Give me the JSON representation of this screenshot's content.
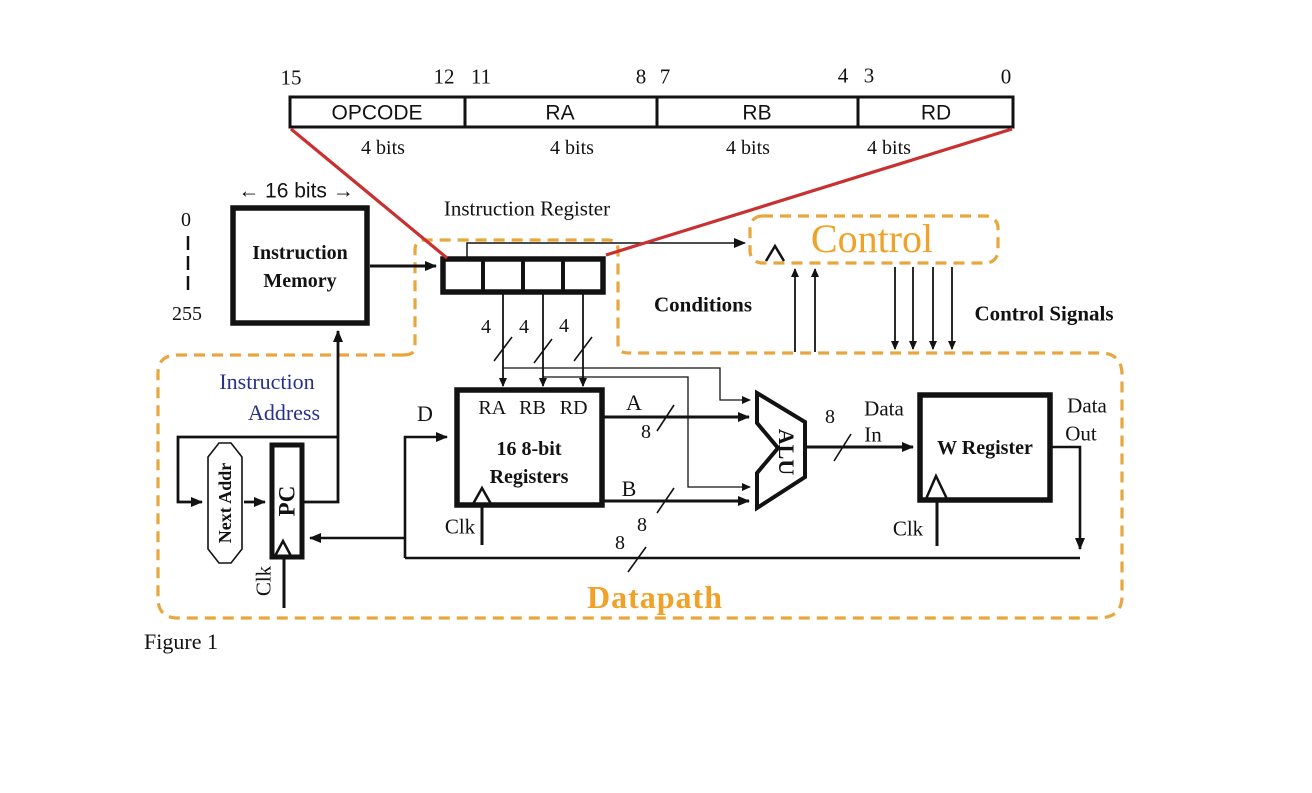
{
  "colors": {
    "orange": "#E9A63E",
    "orange-text": "#F0A127",
    "red": "#C93030",
    "blue": "#28308E",
    "ink": "#121212"
  },
  "figure": {
    "caption": "Figure 1"
  },
  "instruction_format": {
    "bit_labels": [
      "15",
      "12",
      "11",
      "8",
      "7",
      "4",
      "3",
      "0"
    ],
    "fields": [
      {
        "name": "OPCODE",
        "width": "4 bits"
      },
      {
        "name": "RA",
        "width": "4 bits"
      },
      {
        "name": "RB",
        "width": "4 bits"
      },
      {
        "name": "RD",
        "width": "4 bits"
      }
    ]
  },
  "instruction_memory": {
    "width_label": "← 16 bits →",
    "addr_first": "0",
    "addr_last": "255",
    "name_line1": "Instruction",
    "name_line2": "Memory"
  },
  "instruction_register": {
    "label": "Instruction Register",
    "field_width_labels": [
      "4",
      "4",
      "4"
    ]
  },
  "control": {
    "title": "Control",
    "conditions": "Conditions",
    "signals": "Control Signals"
  },
  "datapath": {
    "title": "Datapath",
    "instruction_address": {
      "line1": "Instruction",
      "line2": "Address"
    },
    "next_addr": "Next Addr",
    "pc": "PC",
    "clk_pc": "Clk",
    "clk_regfile": "Clk",
    "clk_wreg": "Clk",
    "regfile": {
      "ports": "RA RB RD",
      "d": "D",
      "name_line1": "16 8-bit",
      "name_line2": "Registers",
      "a": "A",
      "b": "B"
    },
    "alu": "ALU",
    "wreg": "W Register",
    "data_in": {
      "line1": "Data",
      "line2": "In"
    },
    "data_out": {
      "line1": "Data",
      "line2": "Out"
    },
    "bus8": {
      "a": "8",
      "b": "8",
      "alu_out": "8",
      "writeback": "8"
    }
  }
}
